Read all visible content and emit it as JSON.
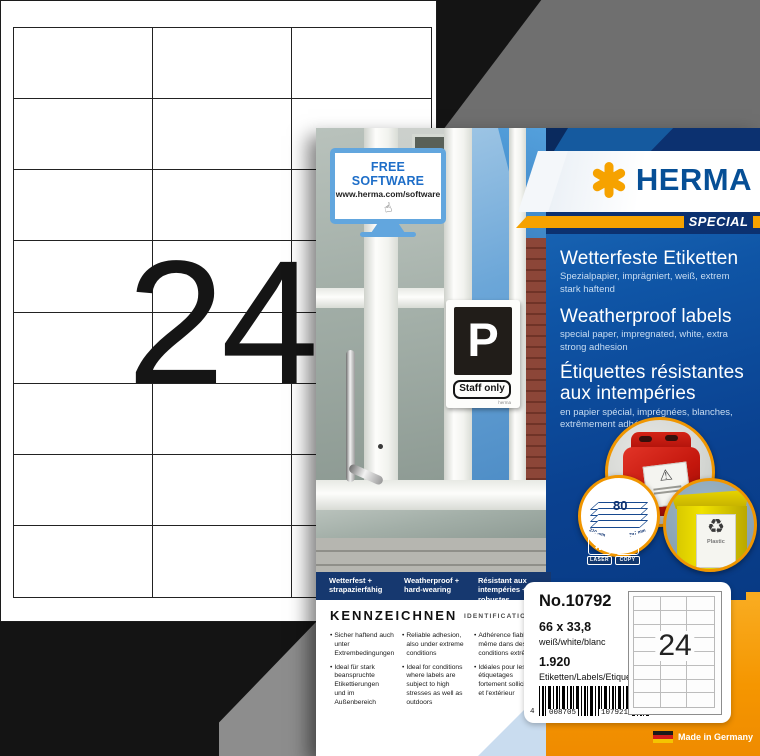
{
  "brand": {
    "name": "HERMA",
    "special": "SPECIAL",
    "accent_orange": "#f6a200",
    "brand_blue": "#064f96",
    "panel_blue": "#0f55a6"
  },
  "sheet": {
    "count": "24",
    "columns": 3,
    "rows": 8
  },
  "software_sign": {
    "title": "FREE SOFTWARE",
    "url": "www.herma.com/software"
  },
  "door_sign": {
    "letter": "P",
    "text": "Staff only",
    "brand": "herma"
  },
  "titles": {
    "de": {
      "title": "Wetterfeste Etiketten",
      "sub": "Spezialpapier, imprägniert, weiß, extrem stark haftend"
    },
    "en": {
      "title": "Weatherproof labels",
      "sub": "special paper, impregnated, white, extra strong adhesion"
    },
    "fr": {
      "title": "Étiquettes résistantes aux intempéries",
      "sub": "en papier spécial, imprégnées, blanches, extrêmement adhésives"
    }
  },
  "sheet_badge": {
    "count": "80",
    "width": "210 mm",
    "height": "297 mm"
  },
  "print_icons": {
    "laser": "LASER",
    "copy": "COPY"
  },
  "bin_label": "Plastic",
  "features_band": [
    "Wetterfest + strapazierfähig",
    "Weatherproof + hard-wearing",
    "Résistant aux intempéries + robustes"
  ],
  "identification": {
    "heading": "KENNZEICHNEN",
    "subheading": "IDENTIFICATION",
    "columns": [
      {
        "bullets": [
          "Sicher haftend auch unter Extrembedingungen",
          "Ideal für stark beanspruchte Etikettierungen und im Außenbereich"
        ]
      },
      {
        "bullets": [
          "Reliable adhesion, also under extreme conditions",
          "Ideal for conditions where labels are subject to high stresses as well as outdoors"
        ]
      },
      {
        "bullets": [
          "Adhérence fiable même dans des conditions extrêmes",
          "Idéales pour les étiquetages fortement sollicités et l'extérieur"
        ]
      }
    ]
  },
  "product": {
    "number": "No.10792",
    "size": "66 x 33,8",
    "color": "weiß/white/blanc",
    "quantity": "1.920",
    "quantity_unit": "Etiketten/Labels/Etiquettes",
    "barcode_prefix": "4",
    "barcode_left": "008705",
    "barcode_right": "107921",
    "preview_count": "24"
  },
  "made_in": "Made in Germany"
}
